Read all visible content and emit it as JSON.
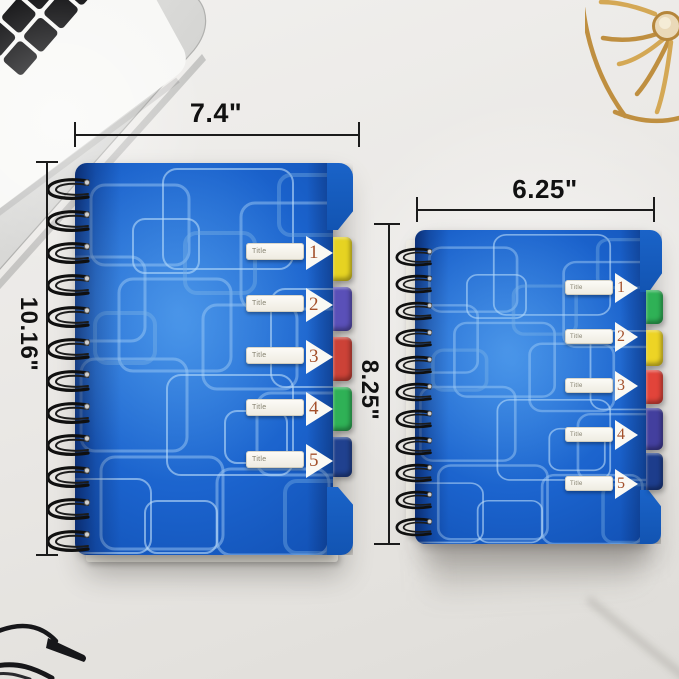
{
  "photo": {
    "type": "product-photo-with-dimension-annotations",
    "desk_color": "#e9e7e4",
    "background_objects": [
      {
        "name": "laptop",
        "position": "top-left"
      },
      {
        "name": "paper-sheet",
        "position": "top-left"
      },
      {
        "name": "gold-wire-basket",
        "position": "top-right"
      },
      {
        "name": "eyeglasses",
        "position": "bottom-left"
      }
    ]
  },
  "annotations": {
    "line_color": "#1b1b1b",
    "large_width_label": "7.4\"",
    "large_height_label": "10.16\"",
    "small_width_label": "6.25\"",
    "small_height_label": "8.25\""
  },
  "large_notebook": {
    "cover_color": "#1b63cd",
    "pattern_color": "#9cc6f2",
    "spiral_color": "#111111",
    "tab_number_color": "#a4512c",
    "tabs": [
      {
        "label": "Title",
        "number": "1",
        "color": "#e6d322"
      },
      {
        "label": "Title",
        "number": "2",
        "color": "#5a50b8"
      },
      {
        "label": "Title",
        "number": "3",
        "color": "#cc4237"
      },
      {
        "label": "Title",
        "number": "4",
        "color": "#2fb156"
      },
      {
        "label": "Title",
        "number": "5",
        "color": "#20418f"
      }
    ]
  },
  "small_notebook": {
    "cover_color": "#1b63cd",
    "pattern_color": "#9cc6f2",
    "spiral_color": "#111111",
    "tab_number_color": "#a4512c",
    "tabs": [
      {
        "label": "Title",
        "number": "1",
        "color": "#2fb156"
      },
      {
        "label": "Title",
        "number": "2",
        "color": "#edd425"
      },
      {
        "label": "Title",
        "number": "3",
        "color": "#e2443a"
      },
      {
        "label": "Title",
        "number": "4",
        "color": "#433f9e"
      },
      {
        "label": "Title",
        "number": "5",
        "color": "#1d3d8c"
      }
    ]
  }
}
